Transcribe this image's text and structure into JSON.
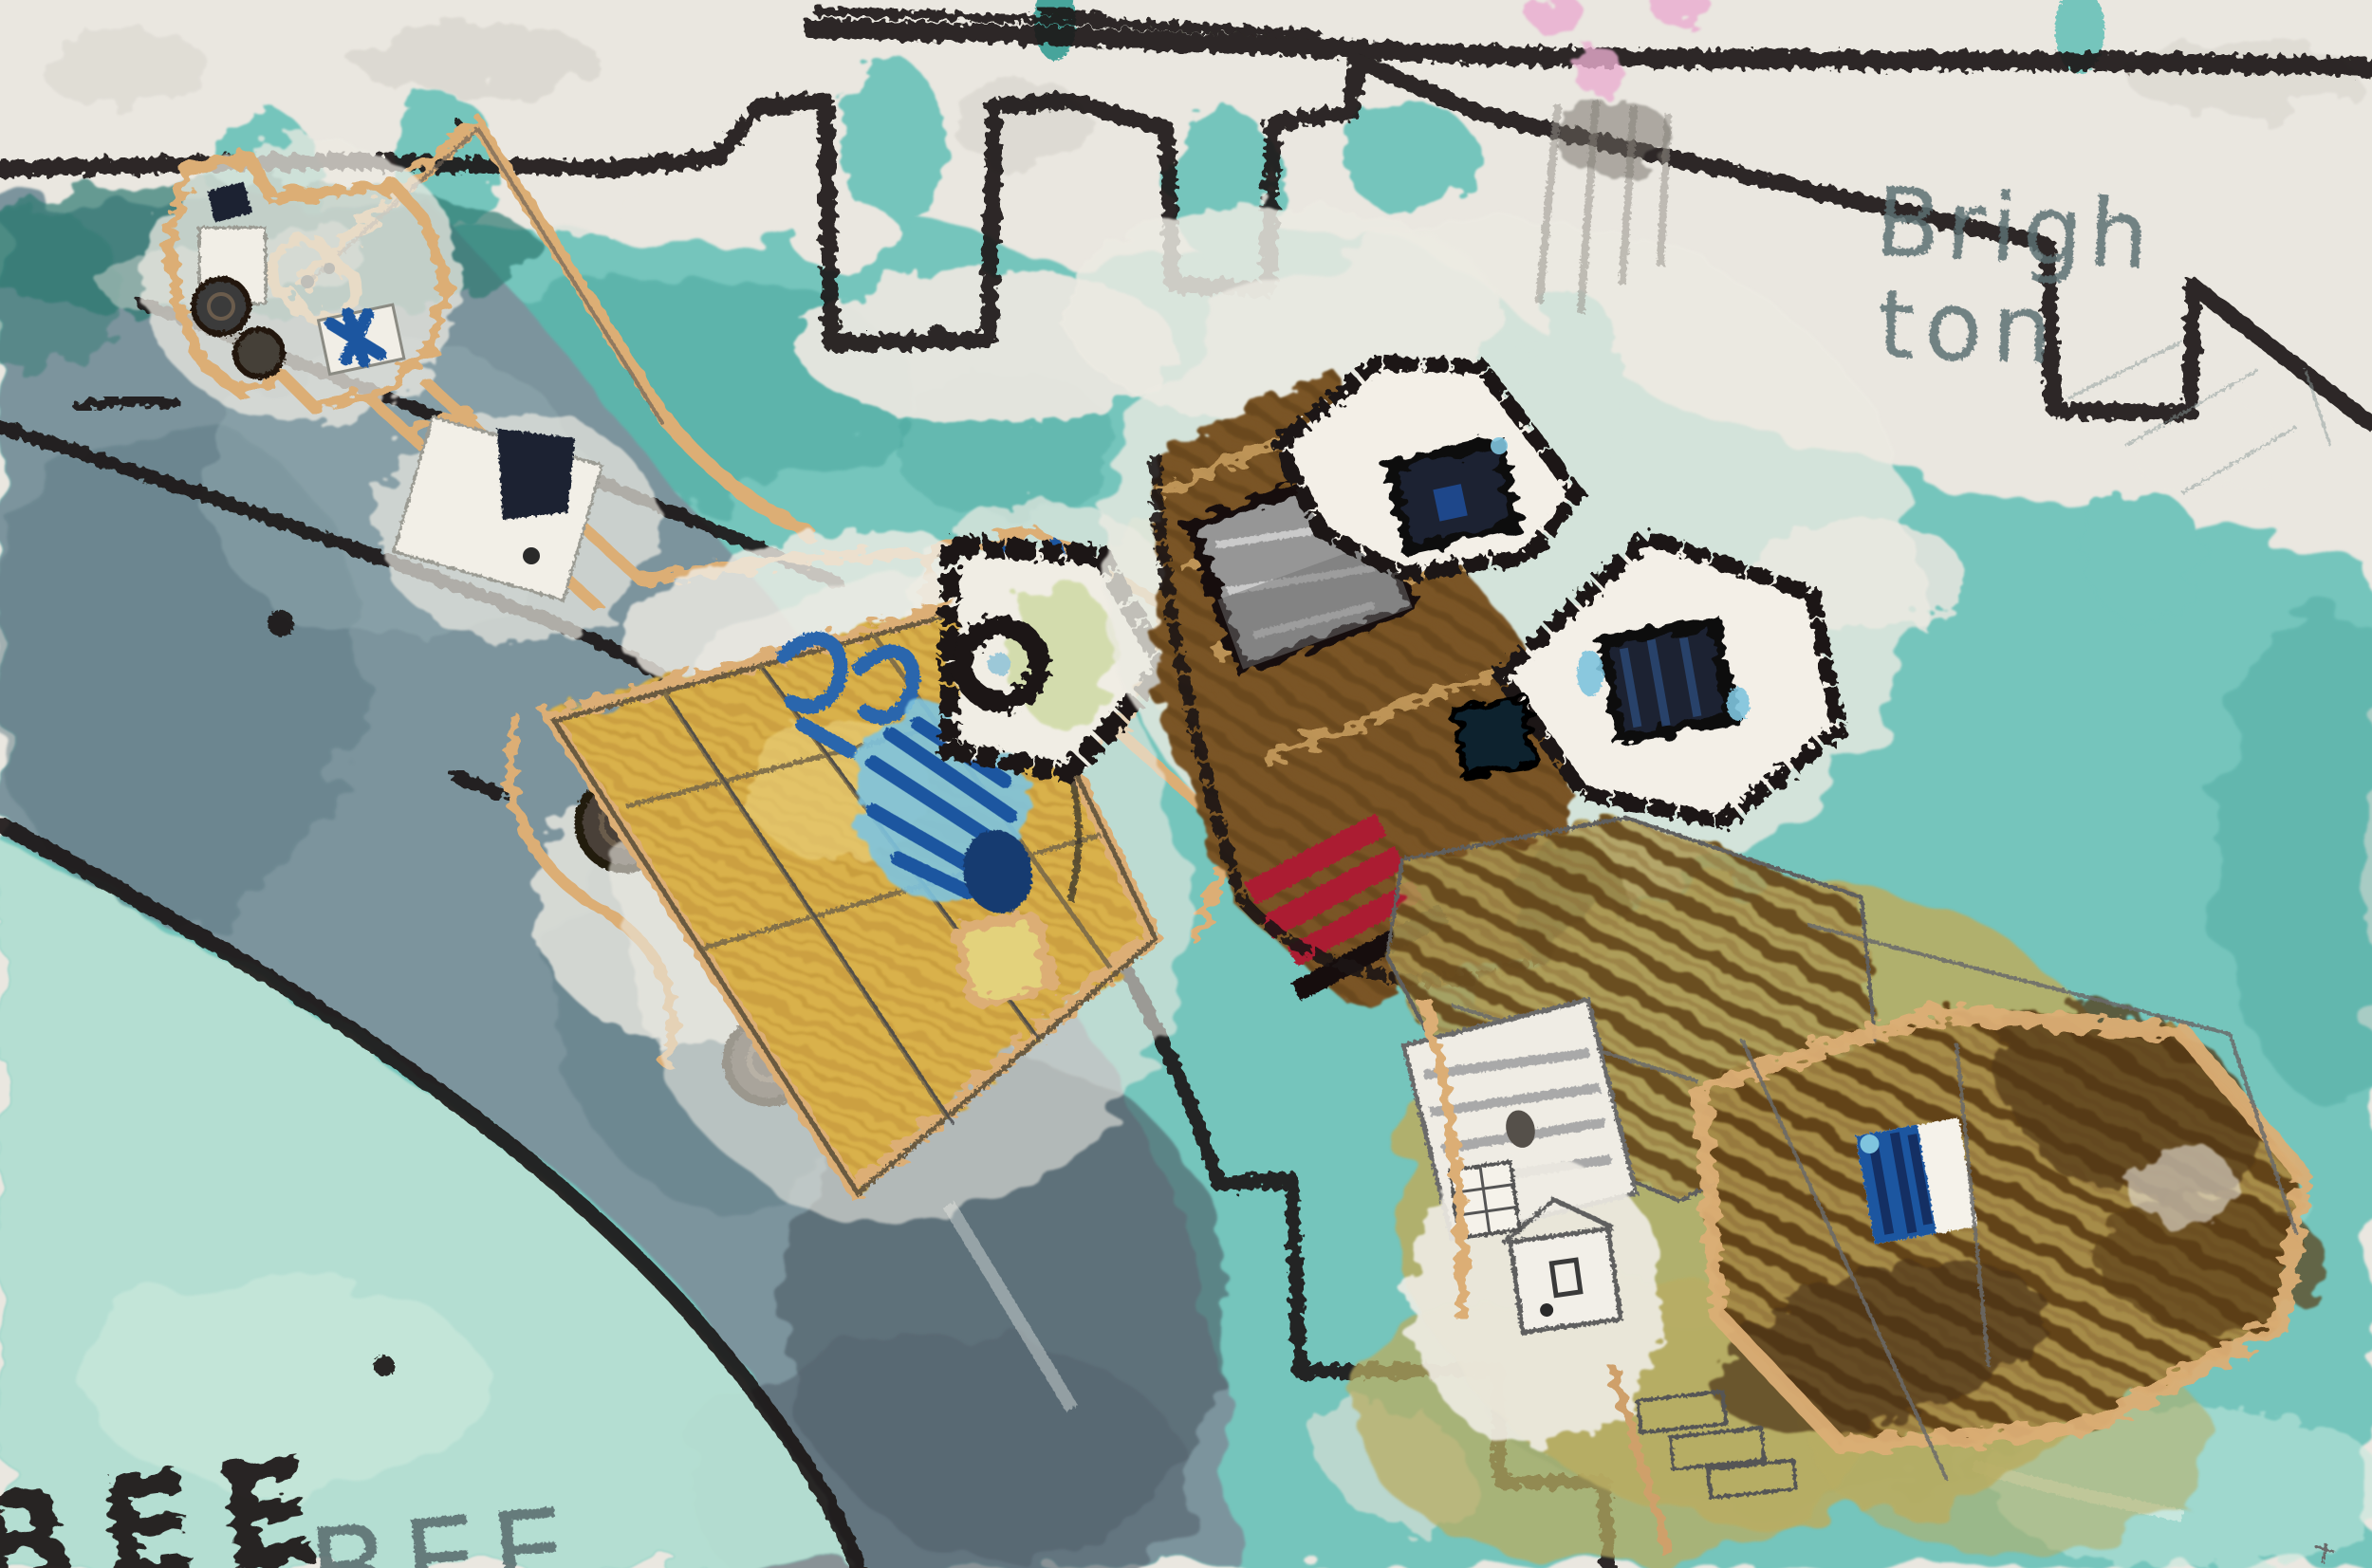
{
  "artwork": {
    "title": "Brighton",
    "annotations": {
      "place_line1": "Brigh",
      "place_line2": "ton",
      "signature_crayon": "BEE",
      "signature_pencil": "BEE"
    },
    "palette": {
      "paper": "#eae7e0",
      "paper_smudge": "#d2cfc7",
      "sea_teal": "#74c5bc",
      "sea_teal_deep": "#46a49b",
      "sea_mint": "#b7e0d3",
      "sea_dark_green": "#2f7a72",
      "shore_gray": "#7b949d",
      "shore_gray_dark": "#57656f",
      "crayon_black": "#1a1713",
      "pencil_gray": "#5c6f72",
      "outline_tan": "#dcae74",
      "pier_yellow": "#d9b14b",
      "building_brown": "#7a5427",
      "scribble_brown": "#5c3c16",
      "khaki": "#b9ad62",
      "flag_blue": "#1c56a0",
      "flag_cyan": "#7fc4de",
      "stripe_red": "#ab1f32",
      "splotch_pink": "#eaaed0",
      "window_navy": "#1a2430"
    }
  }
}
